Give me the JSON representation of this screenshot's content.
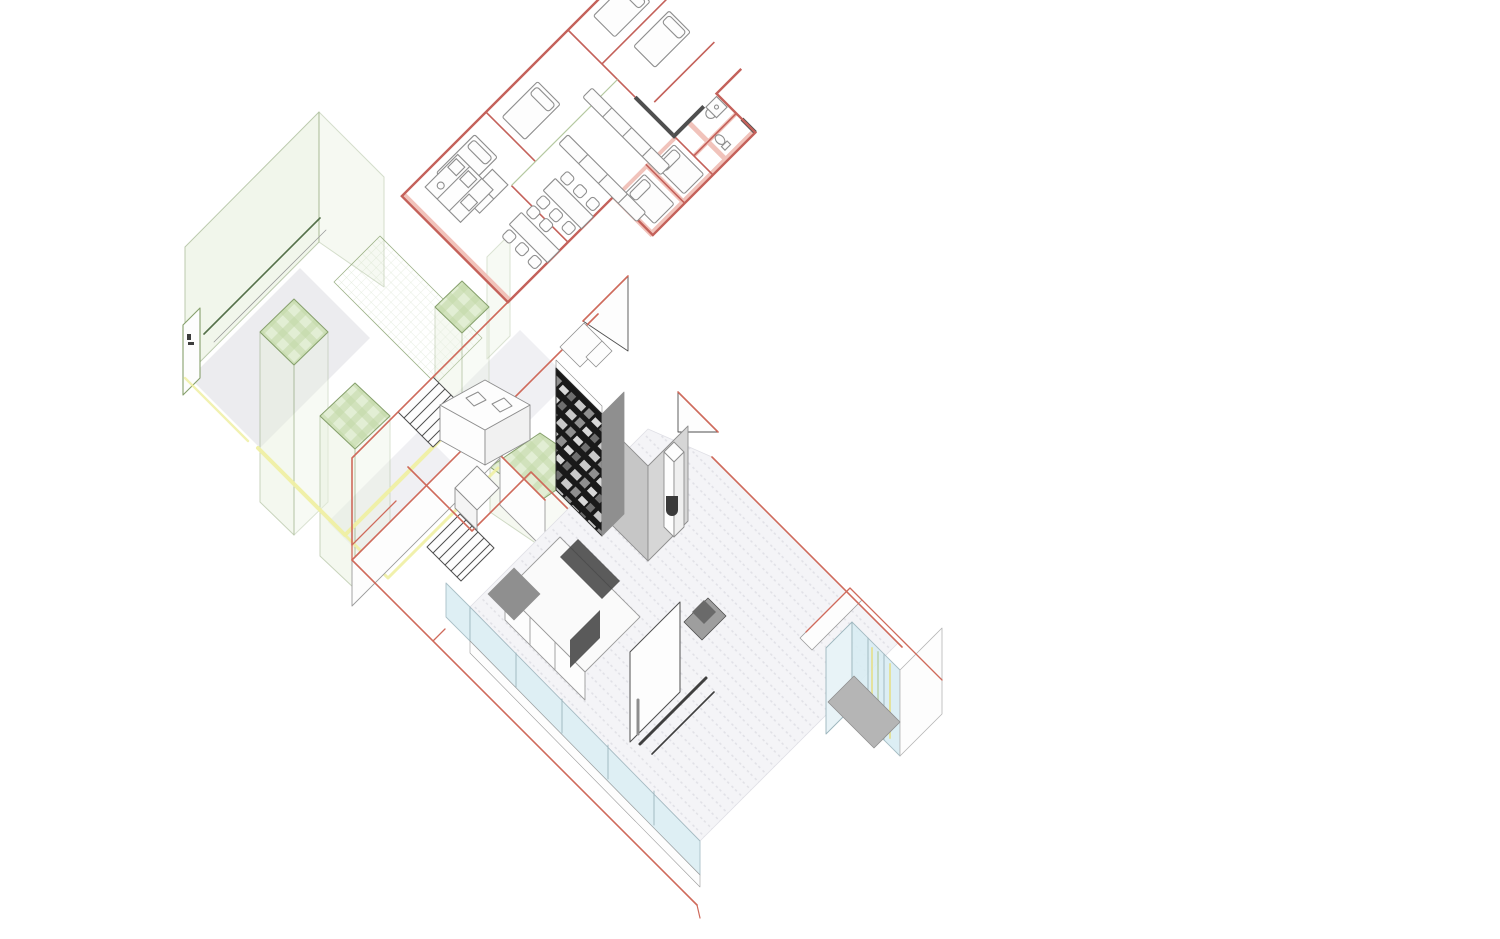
{
  "meta": {
    "type": "architectural-exploded-axonometric-drawing",
    "subject": "two-storey house: upper floor plan lifted above ground-floor volumes",
    "canvas": {
      "width": 1500,
      "height": 939
    }
  },
  "palette": {
    "paper": "#ffffff",
    "plan_wall_red": "#c4615a",
    "plan_wall_pink": "#f0bdb4",
    "wall_dark": "#4f4f4f",
    "furniture_gray": "#8e8e8e",
    "slab_red": "#cf6a5b",
    "green_edge": "#86a06c",
    "green_dark": "#55714a",
    "green_fill": "#e7f0dc",
    "plaid_light": "#e2eed4",
    "plaid_dark": "#c3d8a8",
    "grid_green": "#a8c494",
    "floor_gray": "#e9e9ed",
    "corridor_gray": "#e2e2e7",
    "vol_gray": "#c6c6c6",
    "vol_gray_light": "#d6d6d6",
    "vol_gray_dark": "#8f8f8f",
    "books_bg": "#191919",
    "books_row_a": "#c9c9c9",
    "books_row_b": "#8f8f8f",
    "books_row_c": "#d8d8d8",
    "books_row_d": "#6f6f6f",
    "glass_fill": "#d9edf3",
    "glass_frame": "#9cb5bd",
    "glass_yellow": "#e6df87",
    "glass_green": "#b8d0a6",
    "accent_yellow": "#efefa3",
    "base_gray": "#b5b5b5",
    "line_gray": "#9b9b9b",
    "floor_line": "#e0e0e6",
    "white": "#fdfdfd",
    "corridor_green_line": "#b5c9a0",
    "niche_dark": "#3a3a3a"
  },
  "scene": {
    "upper_floor_plan": {
      "label": "upper floor plan (red walls, cut by top edge of sheet)",
      "rooms": [
        "bedroom",
        "bedroom",
        "bedroom",
        "bedroom",
        "bathroom",
        "shower-room",
        "kitchen",
        "dining-area",
        "corridor"
      ],
      "furniture": [
        "bed",
        "bed",
        "bed",
        "bed",
        "bed",
        "bed",
        "wardrobe",
        "kitchen-units",
        "long-counter",
        "long-counter",
        "dining-table",
        "dining-table",
        "chairs",
        "toilet",
        "sink",
        "shower"
      ]
    },
    "ground_floor": {
      "label": "ground floor axonometric volumes",
      "elements": [
        "greenhouse-glass-volume",
        "hatched-green-column",
        "hatched-green-column",
        "hatched-green-column",
        "hatched-green-box",
        "mesh-roof-band",
        "garden-door-panel",
        "yellow-parapet-walls",
        "stair-upper",
        "stair-lower",
        "cut-walls-with-red-slab-edges",
        "gable-triangle",
        "gable-triangle",
        "kitchen-island",
        "kitchen-counter-run",
        "dark-bookshelf",
        "gray-core-walls",
        "fireplace-column",
        "living-room-floor",
        "glass-facade-band",
        "glass-window-bay",
        "sofa-cabinet-unit",
        "red-slab-outline"
      ]
    }
  }
}
